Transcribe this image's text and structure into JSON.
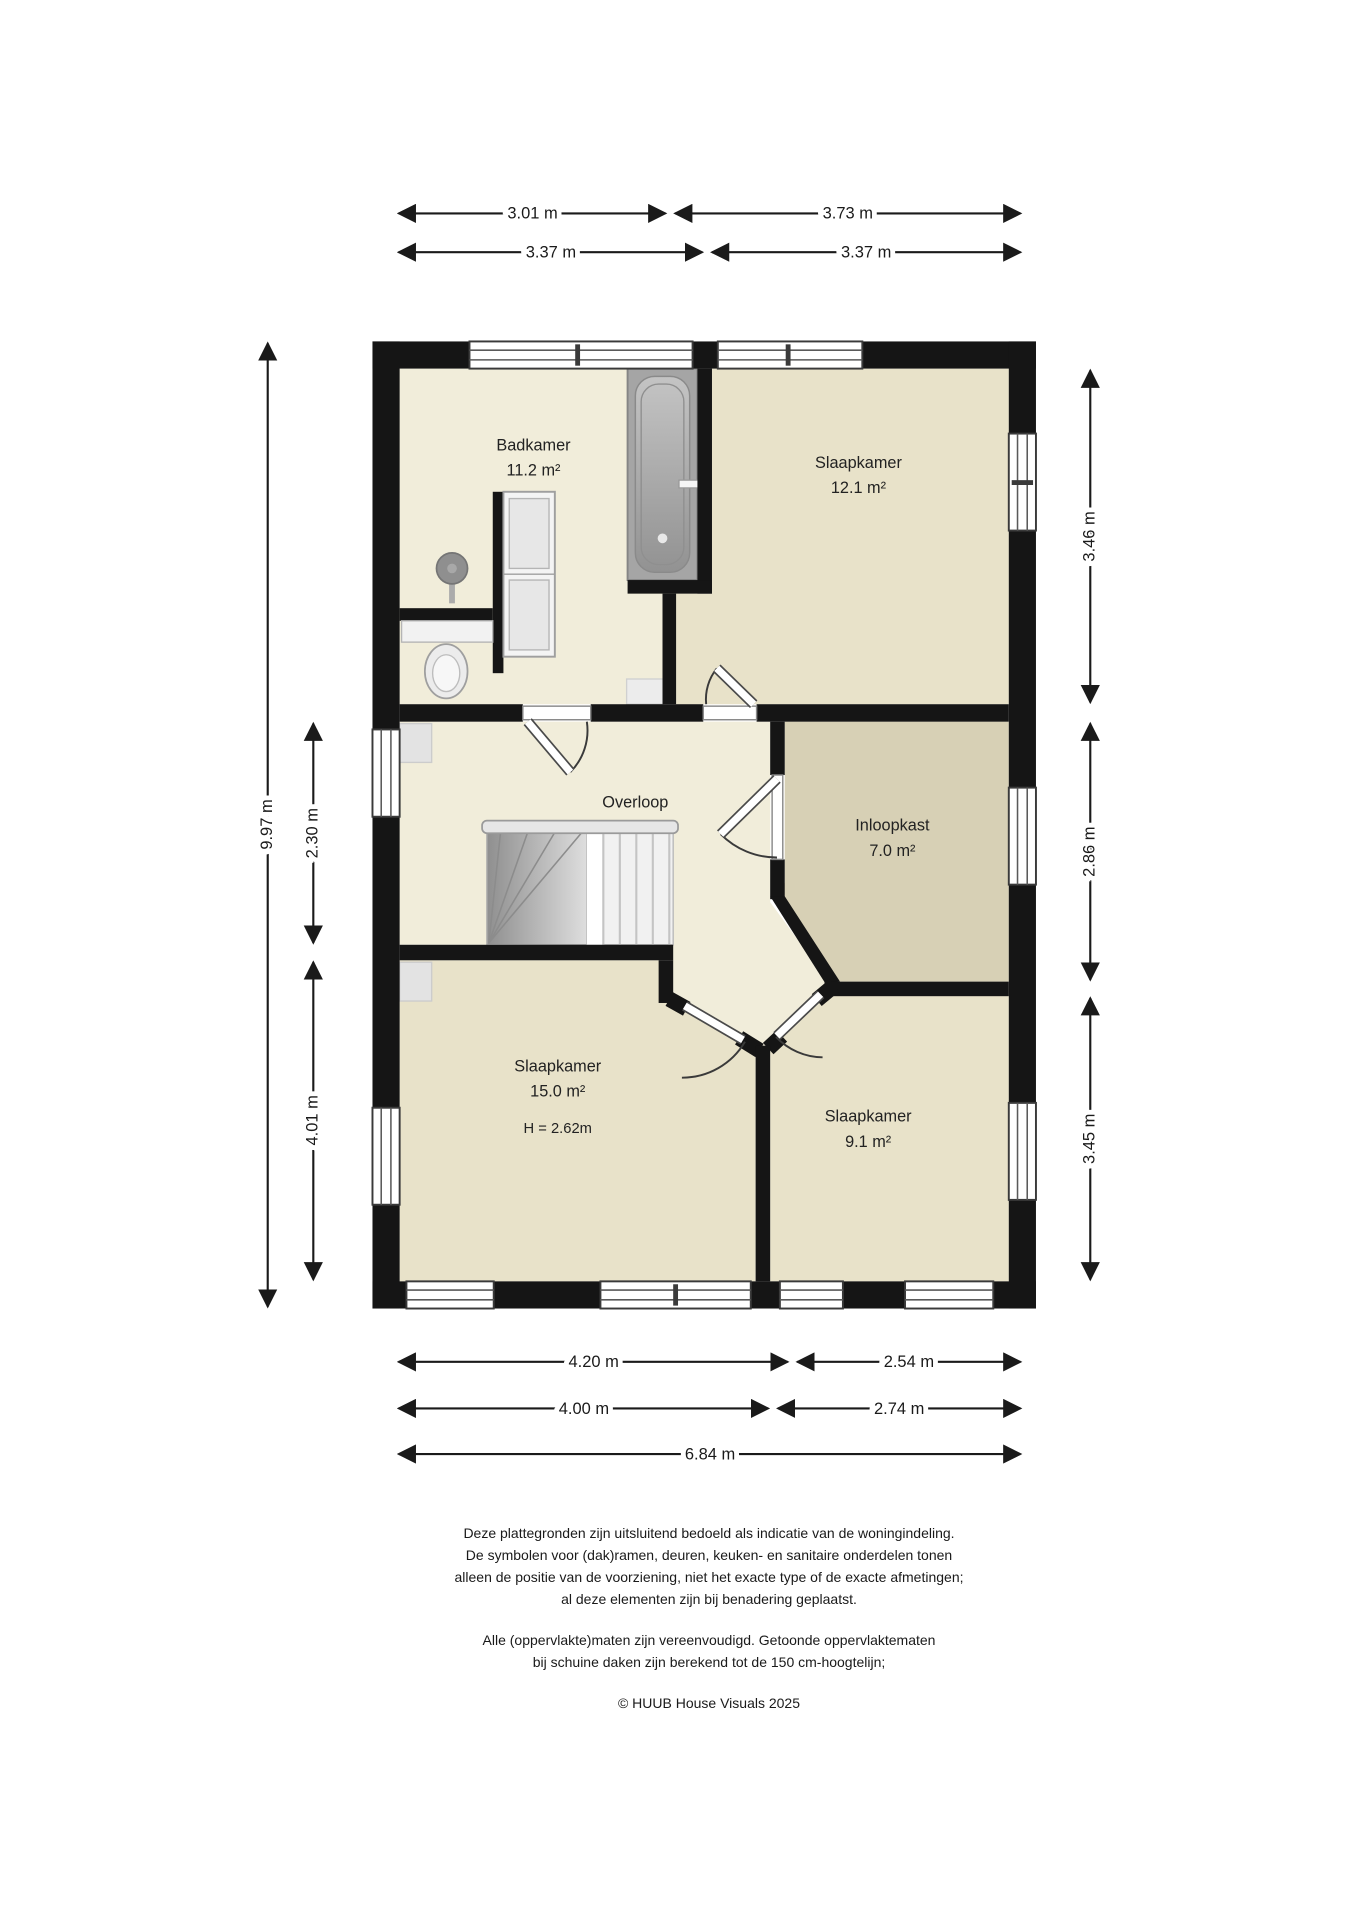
{
  "colors": {
    "floor": "#f1edda",
    "bedroom": "#e8e2c9",
    "closet": "#d7d0b5",
    "wall": "#151515"
  },
  "rooms": {
    "badkamer": {
      "name": "Badkamer",
      "area": "11.2 m²"
    },
    "slaapkamer_12": {
      "name": "Slaapkamer",
      "area": "12.1 m²"
    },
    "overloop": {
      "name": "Overloop"
    },
    "inloopkast": {
      "name": "Inloopkast",
      "area": "7.0 m²"
    },
    "slaapkamer_15": {
      "name": "Slaapkamer",
      "area": "15.0 m²",
      "height_note": "H = 2.62m"
    },
    "slaapkamer_9": {
      "name": "Slaapkamer",
      "area": "9.1 m²"
    }
  },
  "dimensions": {
    "top_row1_left": "3.01 m",
    "top_row1_right": "3.73 m",
    "top_row2_left": "3.37 m",
    "top_row2_right": "3.37 m",
    "left_total": "9.97 m",
    "left_overloop": "2.30 m",
    "left_slaapkamer": "4.01 m",
    "right_top": "3.46 m",
    "right_mid": "2.86 m",
    "right_bottom": "3.45 m",
    "bottom_row1_left": "4.20 m",
    "bottom_row1_right": "2.54 m",
    "bottom_row2_left": "4.00 m",
    "bottom_row2_right": "2.74 m",
    "bottom_total": "6.84 m"
  },
  "footer": {
    "disclaimer_line1": "Deze plattegronden zijn uitsluitend bedoeld als indicatie van de woningindeling.",
    "disclaimer_line2": "De symbolen voor (dak)ramen, deuren, keuken- en sanitaire onderdelen tonen",
    "disclaimer_line3": "alleen de positie van de voorziening, niet het exacte type of de exacte afmetingen;",
    "disclaimer_line4": "al deze elementen zijn bij benadering geplaatst.",
    "note_line1": "Alle (oppervlakte)maten zijn vereenvoudigd. Getoonde oppervlaktematen",
    "note_line2": "bij schuine daken zijn berekend tot de 150 cm-hoogtelijn;",
    "copyright": "© HUUB House Visuals 2025"
  }
}
